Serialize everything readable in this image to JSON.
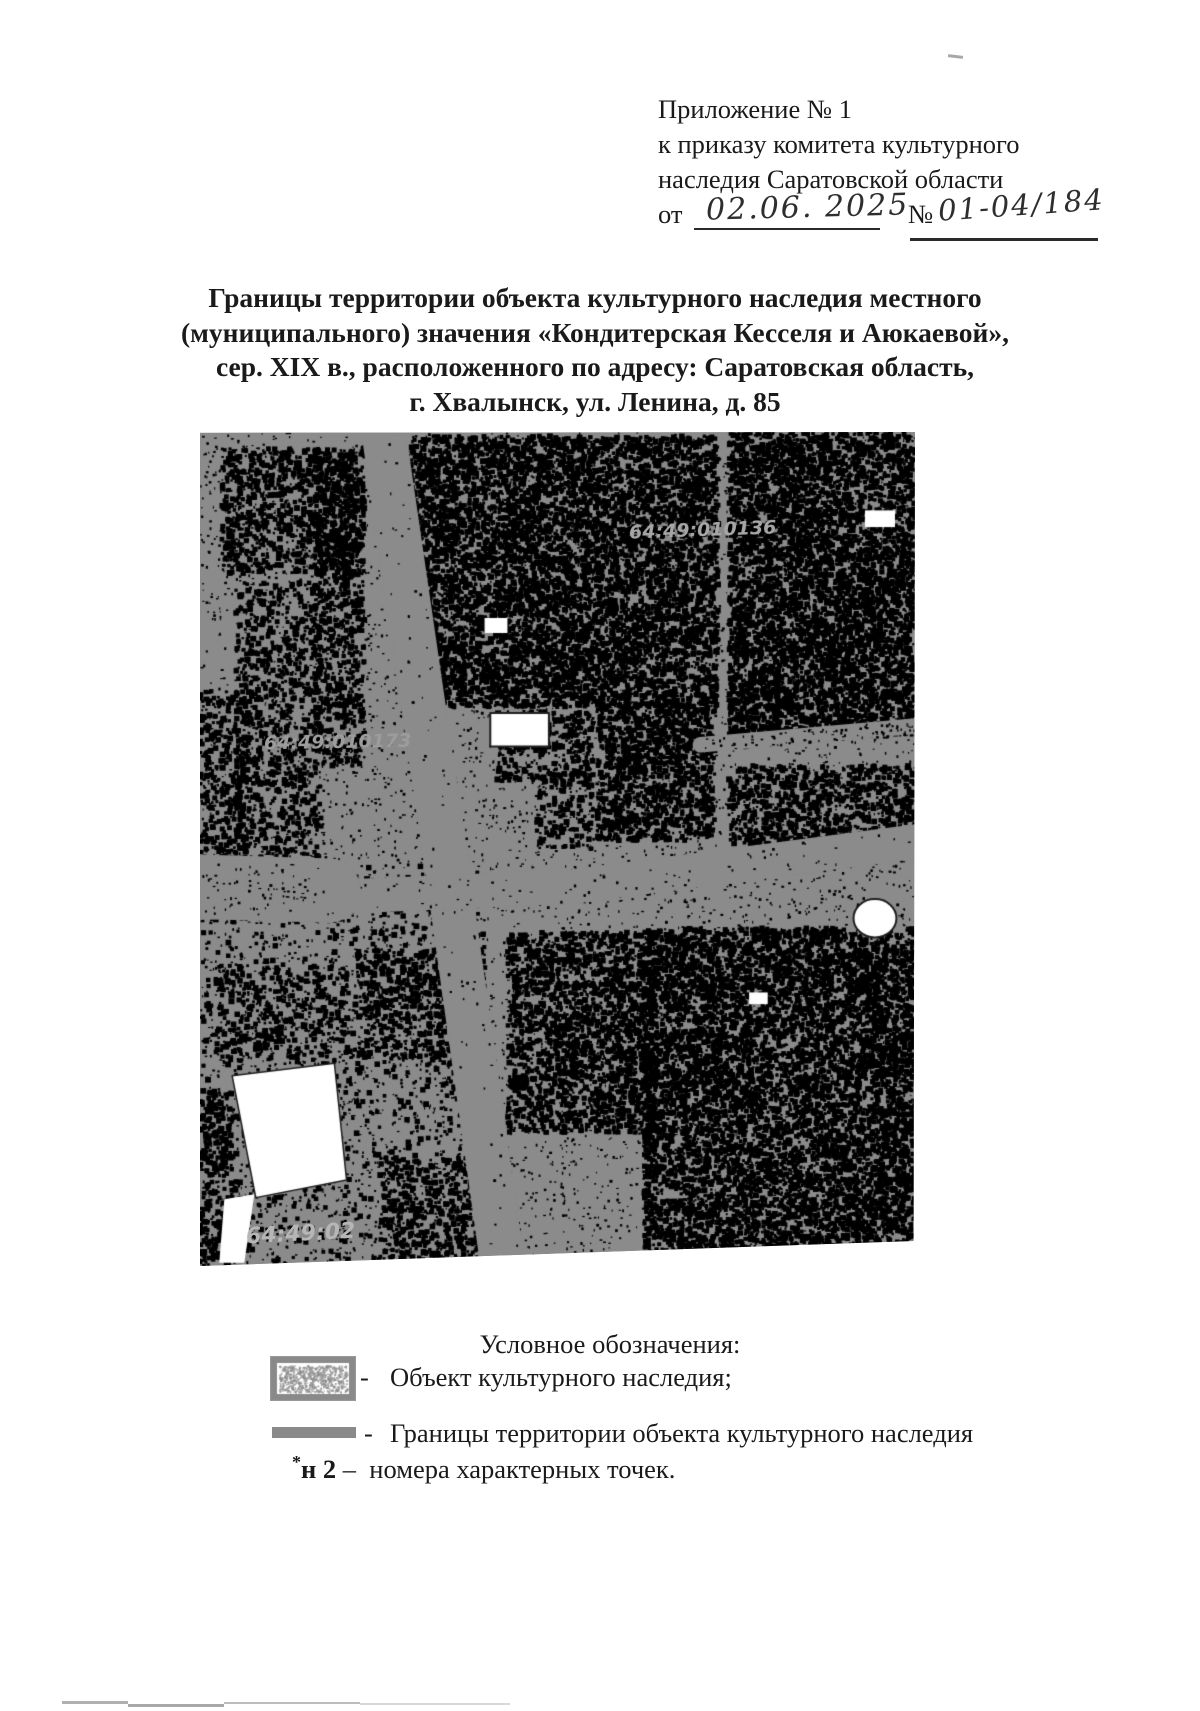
{
  "page": {
    "background": "#ffffff"
  },
  "header": {
    "line1": "Приложение № 1",
    "line2": "к приказу комитета культурного",
    "line3": "наследия Саратовской области",
    "from_label": "от",
    "date_value": "02.06. 2025",
    "number_sign": "№",
    "number_value": "01-04/184"
  },
  "title": {
    "line1": "Границы территории объекта культурного наследия местного",
    "line2": "(муниципального) значения «Кондитерская Кесселя и Аюкаевой»,",
    "line3": "сер. XIX в., расположенного по адресу: Саратовская область,",
    "line4": "г. Хвалынск, ул. Ленина, д. 85"
  },
  "map": {
    "type": "binarized-satellite-plan",
    "colors": {
      "base": "#8b8b8b",
      "dark": "#000000",
      "light": "#ffffff"
    },
    "labels": [
      {
        "text": "64:49:010136",
        "x": 0.6,
        "y": 0.118,
        "rot": -2,
        "size": 19,
        "color": "#a6a6a6"
      },
      {
        "text": "64:49:010173",
        "x": 0.09,
        "y": 0.372,
        "rot": -1,
        "size": 19,
        "color": "#9c9c9c"
      },
      {
        "text": "64:49:02",
        "x": 0.065,
        "y": 0.962,
        "rot": -3,
        "size": 22,
        "color": "#b6b6b6"
      }
    ],
    "features": {
      "black_regions": [
        [
          0.03,
          0.02,
          0.2,
          0.15,
          0.5
        ],
        [
          0.16,
          0.02,
          0.07,
          0.38,
          0.45
        ],
        [
          0.05,
          0.18,
          0.12,
          0.33,
          0.35
        ],
        [
          0.0,
          0.31,
          0.07,
          0.21,
          0.4
        ],
        [
          0.295,
          0.005,
          0.43,
          0.325,
          0.75
        ],
        [
          0.74,
          0.0,
          0.26,
          0.365,
          0.8
        ],
        [
          0.555,
          0.325,
          0.165,
          0.165,
          0.72
        ],
        [
          0.415,
          0.335,
          0.135,
          0.085,
          0.5
        ],
        [
          0.74,
          0.4,
          0.26,
          0.095,
          0.55
        ],
        [
          0.43,
          0.6,
          0.21,
          0.24,
          0.65
        ],
        [
          0.62,
          0.595,
          0.38,
          0.405,
          0.75
        ],
        [
          0.22,
          0.62,
          0.18,
          0.13,
          0.4
        ],
        [
          0.02,
          0.64,
          0.19,
          0.11,
          0.22
        ],
        [
          0.0,
          0.79,
          0.045,
          0.21,
          0.45
        ],
        [
          0.25,
          0.87,
          0.16,
          0.13,
          0.35
        ],
        [
          0.47,
          0.41,
          0.08,
          0.09,
          0.3
        ],
        [
          0.0,
          0.52,
          0.4,
          0.48,
          0.1
        ]
      ],
      "roads": [
        {
          "pts": [
            [
              0.255,
              -0.01
            ],
            [
              0.345,
              0.52
            ],
            [
              0.425,
              1.01
            ]
          ],
          "width": 0.062
        },
        {
          "pts": [
            [
              -0.01,
              0.565
            ],
            [
              0.52,
              0.545
            ],
            [
              1.01,
              0.49
            ]
          ],
          "width": 0.048
        },
        {
          "pts": [
            [
              0.7,
              0.375
            ],
            [
              1.01,
              0.352
            ]
          ],
          "width": 0.022
        },
        {
          "pts": [
            [
              -0.01,
              0.545
            ],
            [
              0.18,
              0.55
            ]
          ],
          "width": 0.09
        }
      ],
      "white_shapes": [
        {
          "shape": "rect",
          "x": 0.406,
          "y": 0.337,
          "w": 0.082,
          "h": 0.04,
          "outline": true
        },
        {
          "shape": "ellipse",
          "cx": 0.944,
          "cy": 0.583,
          "rx": 0.03,
          "ry": 0.023,
          "outline": true
        },
        {
          "shape": "poly",
          "pts": [
            [
              0.045,
              0.772
            ],
            [
              0.188,
              0.757
            ],
            [
              0.205,
              0.897
            ],
            [
              0.078,
              0.918
            ]
          ],
          "outline": true
        },
        {
          "shape": "poly",
          "pts": [
            [
              0.034,
              0.92
            ],
            [
              0.076,
              0.914
            ],
            [
              0.062,
              0.996
            ],
            [
              0.027,
              0.996
            ]
          ],
          "outline": false
        },
        {
          "shape": "rect",
          "x": 0.93,
          "y": 0.094,
          "w": 0.042,
          "h": 0.02,
          "outline": false
        },
        {
          "shape": "rect",
          "x": 0.398,
          "y": 0.223,
          "w": 0.032,
          "h": 0.018,
          "outline": false
        },
        {
          "shape": "rect",
          "x": 0.768,
          "y": 0.672,
          "w": 0.026,
          "h": 0.014,
          "outline": false
        }
      ]
    }
  },
  "legend": {
    "title": "Условное обозначения:",
    "items": [
      {
        "symbol": "hatched-rect-swatch",
        "dash": "-",
        "label": "Объект культурного наследия;"
      },
      {
        "symbol": "thick-line-swatch",
        "dash": "-",
        "label": "Границы территории объекта культурного наследия"
      },
      {
        "symbol": "point-number-code",
        "star": "*",
        "code": "н 2",
        "dash": "–",
        "label": "номера характерных точек."
      }
    ]
  }
}
